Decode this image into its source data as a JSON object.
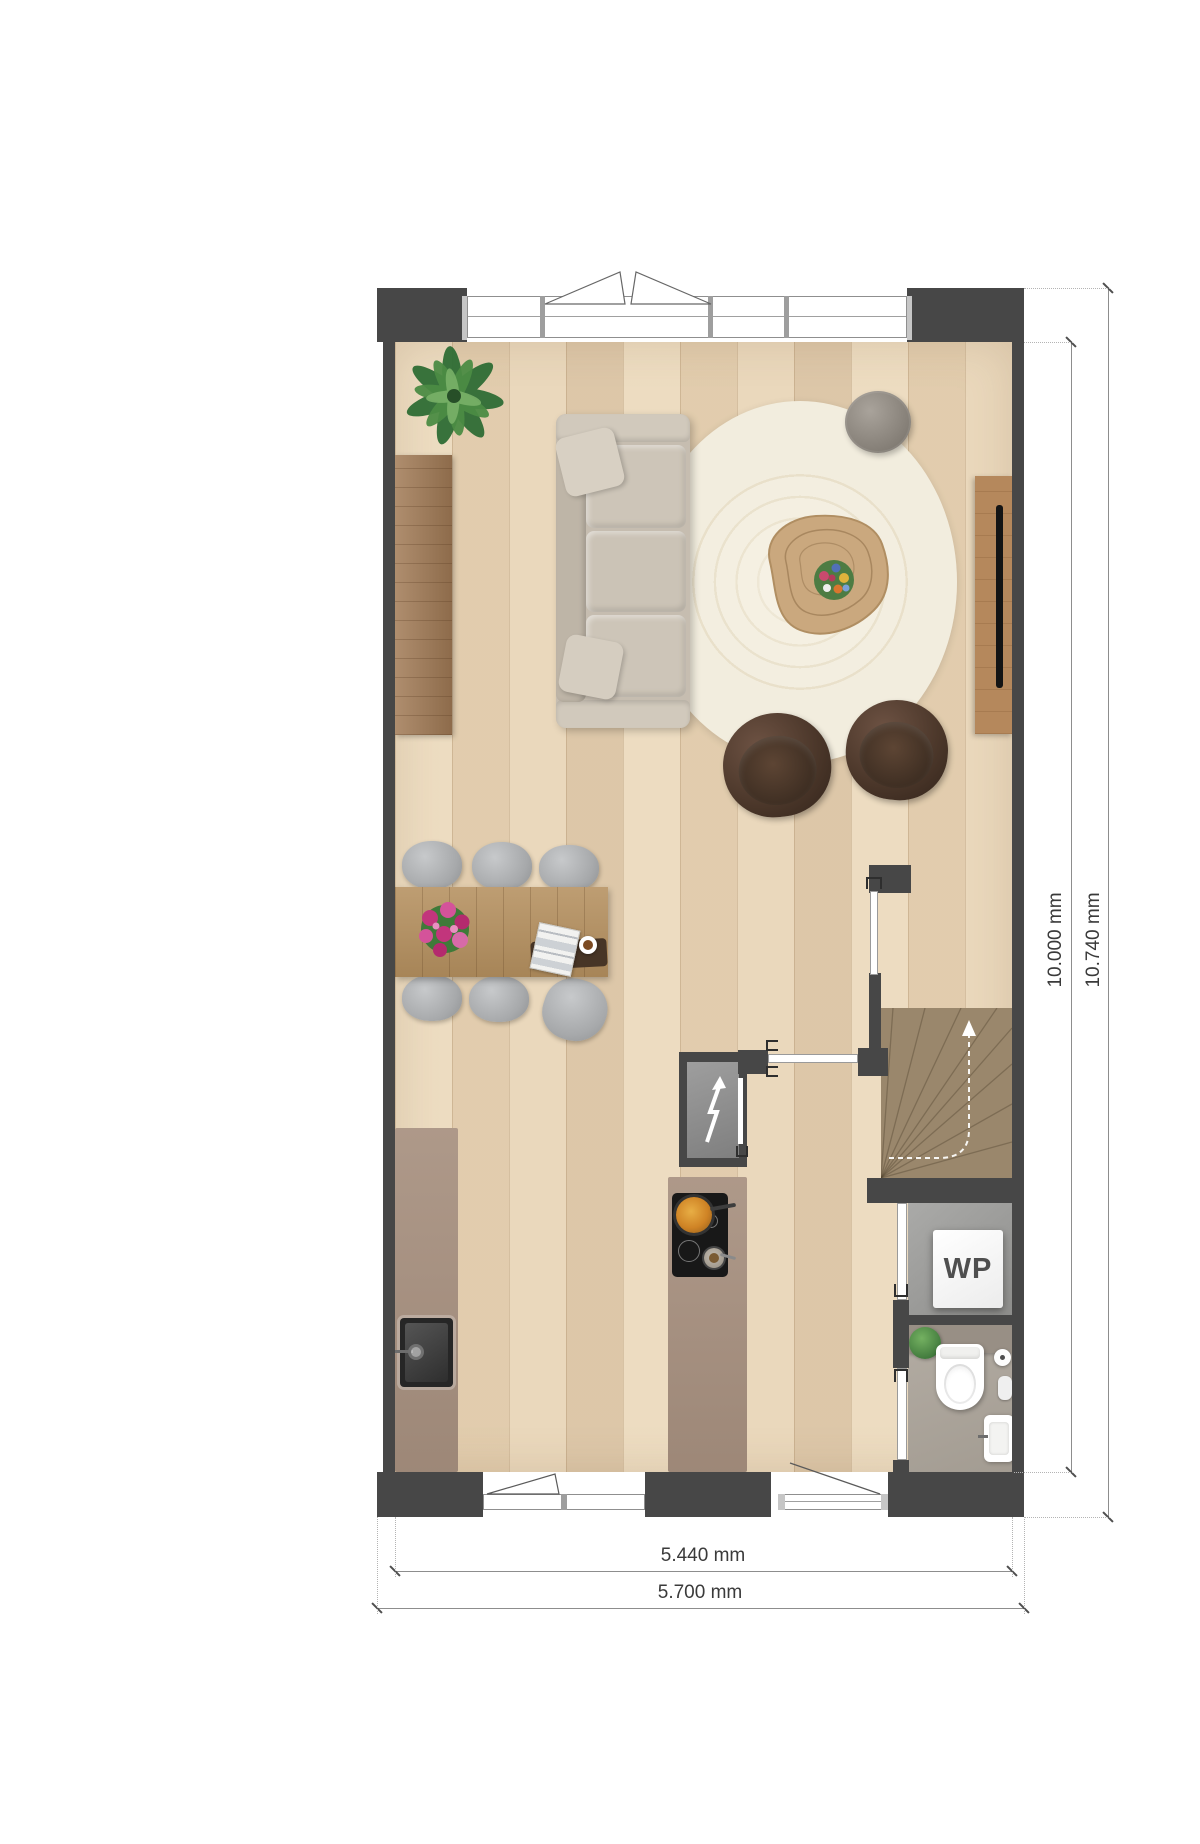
{
  "title": "Floor plan - ground floor",
  "labels": {
    "heat_pump": "WP"
  },
  "dimensions": {
    "inner_height": "10.000 mm",
    "outer_height": "10.740 mm",
    "inner_width": "5.440 mm",
    "outer_width": "5.700 mm"
  },
  "icons": {
    "meter_closet": "lightning-bolt-icon",
    "stairs_direction": "up-arrow-icon"
  },
  "colors": {
    "wall": "#474747",
    "floor_wood": "#e9d6b8",
    "counter_taupe": "#a7907f",
    "rug_cream": "#f3eee1",
    "stairs_beige": "#c9b897",
    "technical_floor_gray": "#9a9a98",
    "toilet_floor_gray": "#aca59c",
    "sofa_beige": "#c6bdb0",
    "armchair_brown": "#4a3629",
    "dining_chair_gray": "#acaeb0",
    "dimension_text": "#3a3a3a"
  }
}
